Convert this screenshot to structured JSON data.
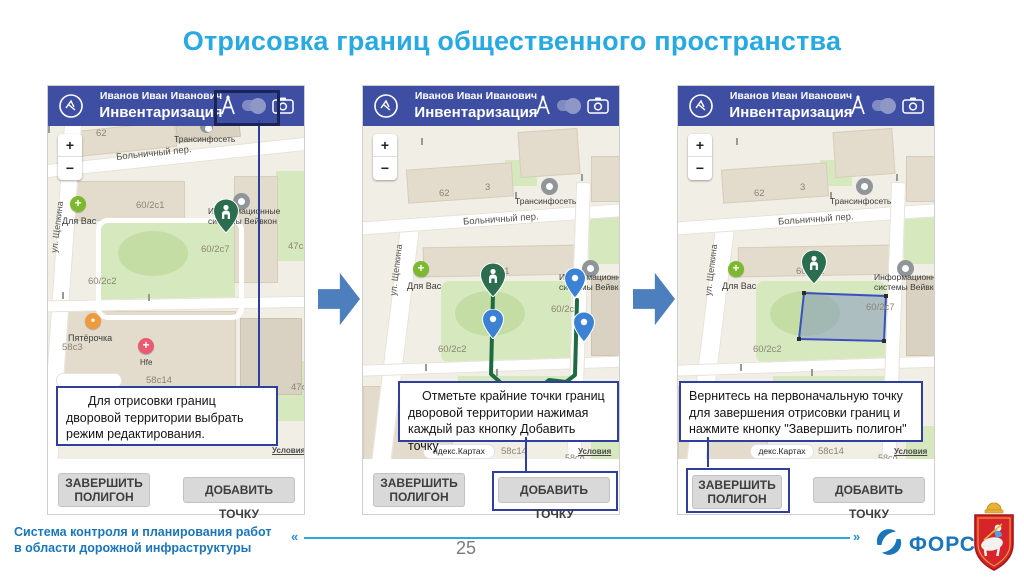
{
  "slide": {
    "title": "Отрисовка границ общественного пространства",
    "page_number": "25",
    "footer": {
      "line1": "Система контроля и планирования работ",
      "line2": "в области дорожной инфраструктуры",
      "open_quote": "«",
      "close_quote": "»",
      "brand": "ФОРС"
    }
  },
  "app": {
    "user_name": "Иванов Иван Иванович",
    "screen_title": "Инвентаризация",
    "zoom_in": "+",
    "zoom_out": "−"
  },
  "buttons": {
    "finish_line1": "ЗАВЕРШИТЬ",
    "finish_line2": "ПОЛИГОН",
    "add_point": "ДОБАВИТЬ ТОЧКУ"
  },
  "steps": [
    {
      "instruction": "Для отрисовки границ дворовой территории выбрать режим редактирования."
    },
    {
      "instruction": "Отметьте крайние точки границ дворовой территории нажимая каждый раз кнопку Добавить точку"
    },
    {
      "instruction": "Вернитесь на первоначальную точку для завершения отрисовки границ и нажмите кнопку \"Завершить полигон\""
    }
  ],
  "map": {
    "street_schepkina": "ул. Щепкина",
    "street_bolnichny": "Больничный пер.",
    "poi_transinfoset": "Трансинфосеть",
    "poi_dlya_vas": "Для Вас",
    "poi_pyaterochka": "Пятёрочка",
    "poi_hfe": "Hfe",
    "vejvkon_line1": "Информационные",
    "vejvkon_line2": "системы Вейвкон",
    "bld_62": "62",
    "bld_3": "3",
    "bld_60_2s1": "60/2с1",
    "bld_60_2s2": "60/2с2",
    "bld_60_2s7": "60/2с7",
    "bld_58s3": "58с3",
    "bld_58s14": "58с14",
    "bld_58so": "58со",
    "bld_47s3": "47с3",
    "attribution_p2": "ндекс.Картах",
    "attribution_p3": "декс.Картах",
    "terms": "Условия"
  },
  "colors": {
    "header_blue": "#3e4ea3",
    "title_blue": "#29a9e1",
    "callout_blue": "#2e3f9e",
    "footer_blue": "#1b75bb",
    "arrow_blue": "#4d7ebd",
    "pin_green": "#2a6e4f",
    "pin_blue": "#3b82d4"
  }
}
